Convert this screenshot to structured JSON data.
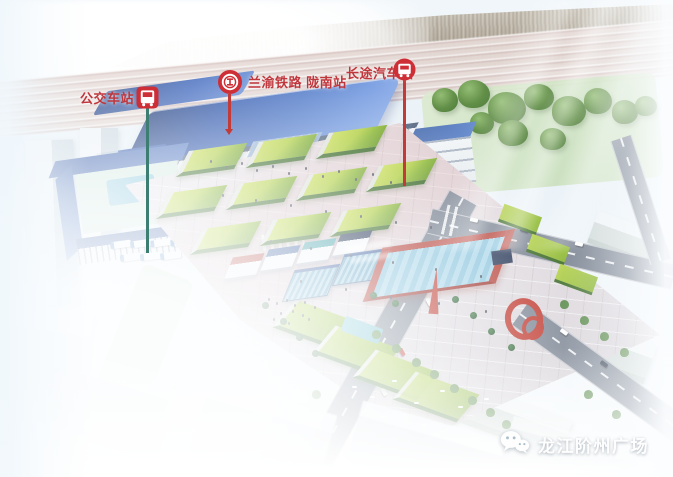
{
  "callouts": {
    "bus": {
      "label": "公交车站",
      "icon": "bus-square-icon",
      "leader_color": "#3c7f72"
    },
    "railway": {
      "label": "兰渝铁路 陇南站",
      "icon": "railway-icon",
      "leader_color": "#c23b38"
    },
    "coach": {
      "label": "长途汽车站",
      "icon": "bus-circle-icon",
      "leader_color": "#c23b38"
    }
  },
  "watermark": {
    "text": "龙江阶州广场",
    "icon": "wechat-icon"
  },
  "colors": {
    "label_red": "#bf363c",
    "icon_red": "#ce2e35",
    "leader_teal": "#3c7f72",
    "station_roof_blue": "#3b62b4",
    "plaza_pavement": "#e4dfe4",
    "lawn_green": "#a9c84a",
    "watermark_white": "#ffffff"
  }
}
